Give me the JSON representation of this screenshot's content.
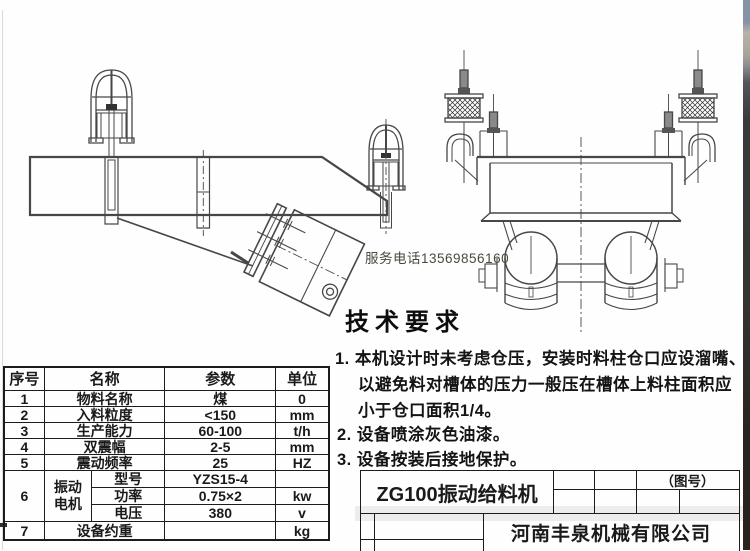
{
  "watermarks": {
    "service_phone": "服务电话13569856160"
  },
  "tech_requirements": {
    "heading": "技术要求",
    "lines": [
      "1. 本机设计时未考虑仓压，安装时料柱仓口应设溜嘴、",
      "以避免料对槽体的压力一般压在槽体上料柱面积应",
      "小于仓口面积1/4。",
      "2. 设备喷涂灰色油漆。",
      "3. 设备按装后接地保护。"
    ]
  },
  "spec_table": {
    "headers": {
      "no": "序号",
      "name": "名称",
      "param": "参数",
      "unit": "单位"
    },
    "rows": [
      {
        "no": "1",
        "name": "物料名称",
        "param": "煤",
        "unit": "0"
      },
      {
        "no": "2",
        "name": "入料粒度",
        "param": "<150",
        "unit": "mm"
      },
      {
        "no": "3",
        "name": "生产能力",
        "param": "60-100",
        "unit": "t/h"
      },
      {
        "no": "4",
        "name": "双震幅",
        "param": "2-5",
        "unit": "mm"
      },
      {
        "no": "5",
        "name": "震动频率",
        "param": "25",
        "unit": "HZ"
      }
    ],
    "motor_row": {
      "no": "6",
      "group_line1": "振动",
      "group_line2": "电机",
      "subs": [
        {
          "name": "型号",
          "param": "YZS15-4",
          "unit": ""
        },
        {
          "name": "功率",
          "param": "0.75×2",
          "unit": "kw"
        },
        {
          "name": "电压",
          "param": "380",
          "unit": "v"
        }
      ]
    },
    "last_row": {
      "no": "7",
      "name": "设备约重",
      "param": "",
      "unit": "kg"
    }
  },
  "title_block": {
    "product": "ZG100振动给料机",
    "drawing_no_label": "（图号）",
    "company": "河南丰泉机械有限公司"
  },
  "colors": {
    "line": "#474747",
    "text": "#1a1a1a",
    "phone_text": "#4b483f"
  }
}
